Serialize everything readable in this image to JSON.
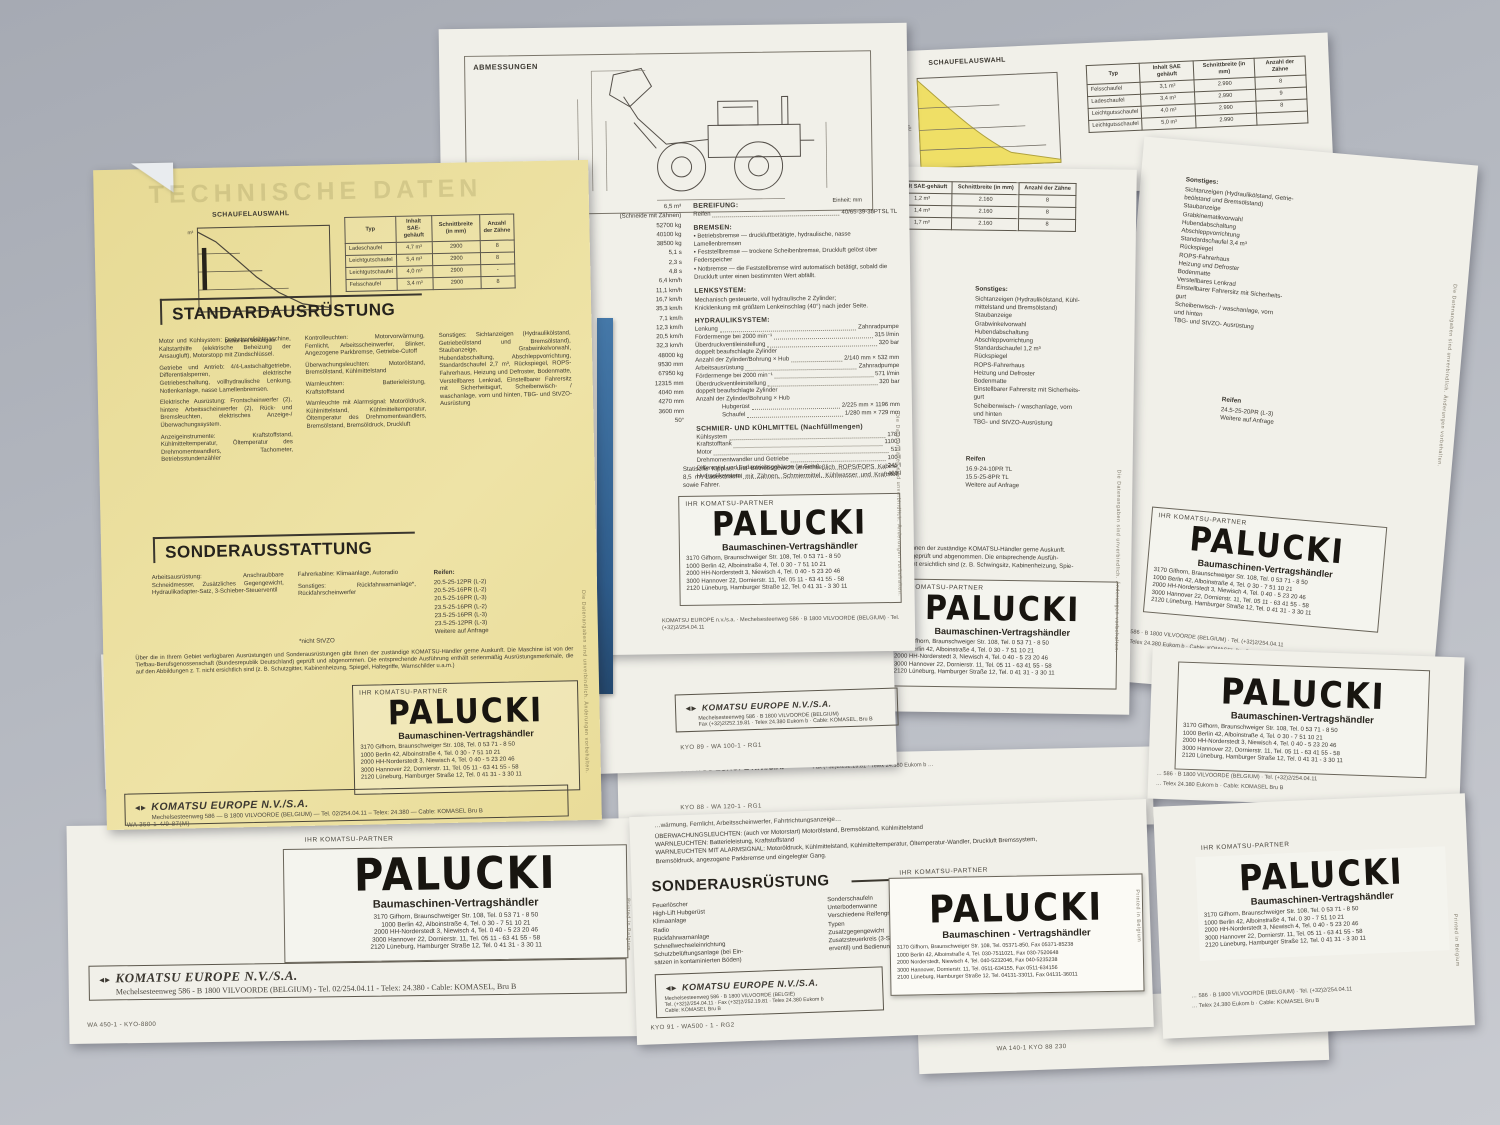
{
  "shared": {
    "partner_label": "IHR KOMATSU-PARTNER",
    "palucki": {
      "name": "PALUCKI",
      "subtitle": "Baumaschinen-Vertragshändler",
      "addresses": [
        "3170 Gifhorn, Braunschweiger Str. 108, Tel. 0 53 71 - 8 50",
        "1000 Berlin 42, Alboinstraße 4, Tel. 0 30 - 7 51 10 21",
        "2000 HH-Norderstedt 3, Niewisch 4, Tel. 0 40 - 5 23 20 46",
        "3000 Hannover 22, Dornierstr. 11, Tel. 05 11 - 63 41 55 - 58",
        "2120 Lüneburg, Hamburger Straße 12, Tel. 0 41 31 - 3 30 11"
      ]
    },
    "palucki_fax": {
      "name": "PALUCKI",
      "subtitle": "Baumaschinen - Vertragshändler",
      "addresses": [
        "3170 Gifhorn, Braunschweiger Str. 108, Tel. 05371-850, Fax 05371-85238",
        "1000 Berlin 42, Alboinstraße 4, Tel. 030-7511021, Fax 030-7520648",
        "2000 Norderstedt, Niewisch 4, Tel. 040-5232046, Fax 040-5235238",
        "3000 Hannover, Dornierstr. 11, Tel. 0511-634155, Fax 0511-634156",
        "2100 Lüneburg, Hamburger Straße 12, Tel. 04131-33011, Fax 04131-36011"
      ]
    },
    "komatsu_mark": "◄►",
    "vilvoorde1": "… 586 · B 1800 VILVOORDE (BELGIUM) · Tel. (+32)2/254.04.11",
    "vilvoorde2": "… Telex 24.380 Eukom b · Cable: KOMASEL Bru B",
    "side_printed": "Printed in Belgium",
    "side_data": "Die Datenangaben sind unverbindlich. Änderungen vorbehalten."
  },
  "yellow": {
    "watermark": "TECHNISCHE DATEN",
    "chart_title": "SCHAUFELAUSWAHL",
    "chart_xlabel": "Dichte des Schüttguts",
    "table": {
      "headers": [
        "Typ",
        "Inhalt SAE-gehäuft",
        "Schnittbreite (in mm)",
        "Anzahl der Zähne"
      ],
      "rows": [
        [
          "Ladeschaufel",
          "4,7 m³",
          "2900",
          "8"
        ],
        [
          "Leichtgutschaufel",
          "5,4 m³",
          "2900",
          "8"
        ],
        [
          "Leichtgutschaufel",
          "4,0 m³",
          "2900",
          "-"
        ],
        [
          "Felsschaufel",
          "3,4 m³",
          "2900",
          "8"
        ]
      ]
    },
    "standard_title": "STANDARDAUSRÜSTUNG",
    "standard_col1": [
      "Motor und Kühlsystem: Drehstromlichtmaschine, Kaltstarthilfe (elektrische Beheizung der Ansaugluft), Motorstopp mit Zündschlüssel.",
      "Getriebe und Antrieb: 4/4-Lastschaltgetriebe, Differentialsperren, elektrische Getriebeschaltung, vollhydraulische Lenkung, Notlenkanlage, nasse Lamellenbremsen.",
      "Elektrische Ausrüstung: Frontscheinwerfer (2), hintere Arbeitsscheinwerfer (2), Rück- und Bremsleuchten, elektrisches Anzeige-/Überwachungssystem.",
      "Anzeigeinstrumente: Kraftstoffstand, Kühlmitteltemperatur, Öltemperatur des Drehmomentwandlers, Tachometer, Betriebsstundenzähler"
    ],
    "standard_col2": [
      "Kontrolleuchten: Motorvorwärmung, Fernlicht, Arbeitsscheinwerfer, Blinker, Angezogene Parkbremse, Getriebe-Cutoff",
      "Überwachungsleuchten: Motorölstand, Bremsölstand, Kühlmittelstand",
      "Warnleuchten: Batterieleistung, Kraftstoffstand",
      "Warnleuchte mit Alarmsignal: Motoröldruck, Kühlmittelstand, Kühlmitteltemperatur, Öltemperatur des Drehmomentwandlers, Bremsölstand, Bremsöldruck, Druckluft"
    ],
    "standard_col3": [
      "Sonstiges: Sichtanzeigen (Hydraulikölstand, Getriebeölstand und Bremsölstand), Staubanzeige, Grabwinkelvorwahl, Hubendabschaltung, Abschleppvorrichtung, Standardschaufel 2,7 m³, Rückspiegel, ROPS-Fahrerhaus, Heizung und Defroster, Bodenmatte, Verstellbares Lenkrad, Einstellbarer Fahrersitz mit Sicherheitsgurt, Scheibenwisch- / waschanlage, vorn und hinten, TBG- und StVZO- Ausrüstung"
    ],
    "sonder_title": "SONDERAUSSTATTUNG",
    "sonder_col1": [
      "Arbeitsausrüstung: Anschraubbare Schneidmesser, Zusätzliches Gegengewicht, Hydraulikadapter-Satz, 3-Schieber-Steuerventil"
    ],
    "sonder_col2": [
      "Fahrerkabine: Klimaanlage, Autoradio",
      "Sonstiges: Rückfahrwarnanlage*, Rückfahrscheinwerfer"
    ],
    "sonder_col3_title": "Reifen:",
    "sonder_col3": [
      "20.5-25-12PR (L-2)",
      "20.5-25-16PR (L-2)",
      "20.5-25-16PR (L-3)",
      "23.5-25-16PR (L-2)",
      "23.5-25-16PR (L-3)",
      "23.5-25-12PR (L-3)",
      "Weitere auf Anfrage"
    ],
    "footnote": "*nicht StVZO",
    "disclaimer": "Über die in Ihrem Gebiet verfügbaren Ausrüstungen und Sonderausrüstungen gibt Ihnen der zuständige KOMATSU-Händler gerne Auskunft. Die Maschine ist von der Tiefbau-Berufsgenossenschaft (Bundesrepublik Deutschland) geprüft und abgenommen. Die entsprechende Ausführung enthält serienmäßig Ausrüstungsmerkmale, die auf den Abbildungen z. T. nicht ersichtlich sind (z. B. Schutzgitter, Kabinenheizung, Spiegel, Haltegriffe, Warnschilder u.a.m.)",
    "footer_title": "KOMATSU EUROPE N.V./S.A.",
    "footer_line": "Mechelsesteenweg 586 — B 1800 VILVOORDE (BELGIUM) — Tel. 02/254.04.11 – Telex: 24.380 — Cable: KOMASEL Bru B",
    "code": "WA 350-1-4/9-87(M)"
  },
  "abm": {
    "title": "ABMESSUNGEN",
    "unit": "Einheit: mm",
    "left_values": [
      "6,5 m³",
      "(Schneide mit Zähnen)",
      "52700 kg",
      "40100 kg",
      "38500 kg",
      "5,1 s",
      "2,3 s",
      "4,8 s",
      "6,4 km/h",
      "11,1 km/h",
      "16,7 km/h",
      "35,3 km/h",
      "7,1 km/h",
      "12,3 km/h",
      "20,5 km/h",
      "32,3 km/h",
      "48000 kg",
      "9530 mm",
      "67950 kg",
      "12315 mm",
      "4040 mm",
      "4270 mm",
      "3600 mm",
      "50°"
    ],
    "bereifung_title": "BEREIFUNG:",
    "bereifung_label": "Reifen",
    "bereifung_value": "40/65-39-38PTSL TL",
    "bremsen_title": "BREMSEN:",
    "bremsen_items": [
      "Betriebsbremse — druckluftbetätigte, hydraulische, nasse Lamellenbremsen",
      "Feststellbremse — trockene Scheibenbremse, Druckluft gelöst über Federspeicher",
      "Notbremse — die Feststellbremse wird automatisch betätigt, sobald die Druckluft unter einen bestimmten Wert abfällt."
    ],
    "lenk_title": "LENKSYSTEM:",
    "lenk_lines": [
      "Mechanisch gesteuerte, voll hydraulische 2 Zylinder;",
      "Knicklenkung mit größtem Lenkeinschlag (40°) nach jeder Seite."
    ],
    "hyd_title": "HYDRAULIKSYSTEM:",
    "hyd_rows": [
      [
        "Lenkung",
        "Zahnradpumpe"
      ],
      [
        "Fördermenge bei 2000 min⁻¹",
        "315 l/min"
      ],
      [
        "Überdruckventileinstellung",
        "320 bar"
      ],
      [
        "doppelt beaufschlagte Zylinder",
        ""
      ],
      [
        "Anzahl der Zylinder/Bohrung × Hub",
        "2/140 mm × 532 mm"
      ],
      [
        "Arbeitsausrüstung",
        "Zahnradpumpe"
      ],
      [
        "Fördermenge bei 2000 min⁻¹",
        "571 l/min"
      ],
      [
        "Überdruckventileinstellung",
        "320 bar"
      ],
      [
        "doppelt beaufschlagte Zylinder",
        ""
      ],
      [
        "Anzahl der Zylinder/Bohrung × Hub",
        ""
      ],
      [
        "      Hubgerüst",
        "2/225 mm × 1196 mm"
      ],
      [
        "      Schaufel",
        "1/280 mm × 729 mm"
      ]
    ],
    "schmier_title": "SCHMIER- UND KÜHLMITTEL (Nachfüllmengen)",
    "schmier_rows": [
      [
        "Kühlsystem",
        "178 l"
      ],
      [
        "Kraftstofftank",
        "1100 l"
      ],
      [
        "Motor",
        "51 l"
      ],
      [
        "Drehmomentwandler und Getriebe",
        "100 l"
      ],
      [
        "Differential und Endantriebsgehäuse (je Seite)",
        "245 l"
      ],
      [
        "Hydrauliksystem",
        "460 l"
      ]
    ],
    "note": "Statische Kipplast und Betriebsgewicht einschließlich ROPS/FOPS Kabine, 8,5 m³ Ladeschaufel mit Zähnen, Schmiermittel, Kühlwasser und Kraftstoff sowie Fahrer.",
    "footer_line": "KOMATSU EUROPE n.v./s.a. · Mechelsesteenweg 586 · B 1800 VILVOORDE (BELGIUM) · Tel. (+32)2/254.04.11"
  },
  "sheet_d": {
    "footer_title": "KOMATSU EUROPE N.V./S.A.",
    "footer_line1": "Mechelsesteenweg 586 · B 1800 VILVOORDE (BELGIUM)",
    "footer_line2": "Fax (+32)2/252.19.81 · Telex 24.380 Eukom b · Cable: KOMASEL, Bru B",
    "code": "KYO 89 - WA 100-1 - RG1"
  },
  "sheet_e": {
    "frag1": "◄► KOMATSU EUROPE N.V./S.A.",
    "frag2": "Fax (+32)2/252.19.81 · Telex 24.380 Eukom b …",
    "code": "KYO 88 - WA 120-1 - RG1"
  },
  "topright": {
    "chart_title": "SCHAUFELAUSWAHL",
    "table": {
      "headers": [
        "Typ",
        "Inhalt SAE gehäuft",
        "Schnittbreite (in mm)",
        "Anzahl der Zähne"
      ],
      "rows": [
        [
          "Felsschaufel",
          "3,1 m³",
          "2.990",
          "8"
        ],
        [
          "Ladeschaufel",
          "3,4 m³",
          "2.990",
          "9"
        ],
        [
          "Leichtgutsschaufel",
          "4,0 m³",
          "2.990",
          "8"
        ],
        [
          "Leichtgutsschaufel",
          "5,0 m³",
          "2.990",
          ""
        ]
      ]
    }
  },
  "midright": {
    "table": {
      "headers": [
        "Inhalt SAE-gehäuft",
        "Schnittbreite (in mm)",
        "Anzahl der Zähne"
      ],
      "rows": [
        [
          "1,2 m³",
          "2.160",
          "8"
        ],
        [
          "1,4 m³",
          "2.160",
          "8"
        ],
        [
          "1,7 m³",
          "2.160",
          "8"
        ]
      ]
    },
    "sonstiges_title": "Sonstiges:",
    "sonstiges_items": [
      "Sichtanzeigen (Hydraulikölstand, Kühl-",
      "mittelstand und Bremsölstand)",
      "Staubanzeige",
      "Grabwinkelvorwahl",
      "Hubendabschaltung",
      "Abschleppvorrichtung",
      "Standardschaufel 1,2 m³",
      "Rückspiegel",
      "ROPS-Fahrerhaus",
      "Heizung und Defroster",
      "Bodenmatte",
      "Einstellbarer Fahrersitz mit Sicherheits-",
      "gurt",
      "Scheibenwisch- / waschanlage, vorn",
      "und hinten",
      "TBG- und StVZO-Ausrüstung"
    ],
    "reifen_title": "Reifen",
    "reifen_items": [
      "16.9-24-10PR TL",
      "15.5-25-8PR TL",
      "Weitere auf Anfrage"
    ],
    "disclaimer_lines": [
      "… gibt Ihnen der zuständige KOMATSU-Händler gerne Auskunft.",
      "…land) geprüft und abgenommen. Die entsprechende Ausfüh-",
      "… T. nicht ersichtlich sind (z. B. Schwingsitz, Kabinenheizung, Spie-"
    ]
  },
  "r1": {
    "sonstiges_title": "Sonstiges:",
    "sonstiges_items": [
      "Sichtanzeigen (Hydraulikölstand, Getrie-",
      "beölstand und Bremsölstand)",
      "Staubanzeige",
      "Grabkinematikvorwahl",
      "Hubendabschaltung",
      "Abschleppvorrichtung",
      "Standardschaufel 3,4 m³",
      "Rückspiegel",
      "ROPS-Fahrerhaus",
      "Heizung und Defroster",
      "Bodenmatte",
      "Verstellbares Lenkrad",
      "Einstellbarer Fahrersitz mit Sicherheits-",
      "gurt",
      "Scheibenwisch- / waschanlage, vorn",
      "und hinten",
      "TBG- und StVZO- Ausrüstung"
    ],
    "reifen_title": "Reifen",
    "reifen_items": [
      "24.5-25-20PR (L-3)",
      "Weitere auf Anfrage"
    ]
  },
  "sheet_f": {
    "cut_line": "…wärmung, Fernlicht, Arbeitsscheinwerfer, Fahrtrichtungsanzeige…",
    "lines": [
      "ÜBERWACHUNGSLEUCHTEN: (auch vor Motorstart) Motorölstand, Bremsölstand, Kühlmittelstand",
      "WARNLEUCHTEN: Batterieleistung, Kraftstoffstand",
      "WARNLEUCHTEN MIT ALARMSIGNAL: Motoröldruck, Kühlmittelstand, Kühlmitteltemperatur, Öltemperatur-Wandler, Druckluft Bremssystem,",
      "Bremsöldruck, angezogene Parkbremse und eingelegter Gang."
    ],
    "sonder_title": "SONDERAUSRÜSTUNG",
    "col1": [
      "Feuerlöscher",
      "High-Lift Hubgerüst",
      "Klimaanlage",
      "Radio",
      "Rückfahrwarnanlage",
      "Schnellwechseleinrichtung",
      "Schutzbelüftungsanlage (bei Ein-",
      "sätzen in kontaminierten Böden)"
    ],
    "col2": [
      "Sonderschaufeln",
      "Unterbodenwanne",
      "Verschiedene Reifengrößen un",
      "Typen",
      "Zusatzgegengewicht",
      "Zusatzsteuerkreis (3-Schieber-Ste-",
      "erventil) und Bedienungselement"
    ],
    "footer_title": "KOMATSU EUROPE N.V./S.A.",
    "footer_lines": [
      "Mechelsesteenweg 586 · B 1800 VILVOORDE (BELGIË)",
      "Tel. (+32)2/254.04.11 · Fax (+32)2/252.19.81 · Telex 24.380 Eukom b",
      "Cable: KOMASEI, Bru B"
    ],
    "code": "KYO 91 - WA500 - 1 - RG2"
  },
  "r3_code": "WA 140-1 KYO 88 230",
  "bottom_left": {
    "footer_title": "KOMATSU EUROPE N.V./S.A.",
    "footer_line": "Mechelsesteenweg 586 - B 1800 VILVOORDE (BELGIUM) - Tel. 02/254.04.11 - Telex: 24.380 - Cable: KOMASEL, Bru B",
    "code": "WA 450-1 - KYO-8800"
  }
}
